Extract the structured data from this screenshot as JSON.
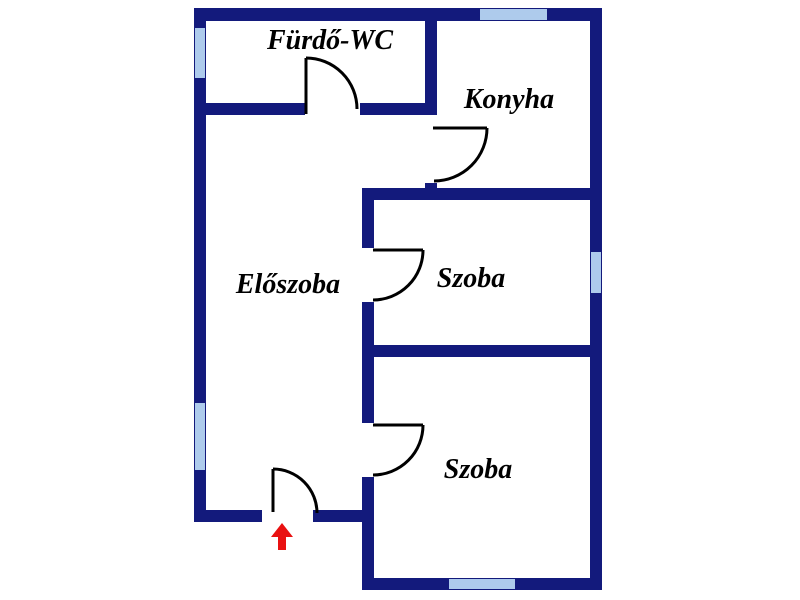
{
  "canvas": {
    "width": 800,
    "height": 600
  },
  "colors": {
    "background": "#ffffff",
    "wall": "#131a7c",
    "window": "#aecbec",
    "door_line": "#000000",
    "arrow": "#e91111",
    "text": "#000000"
  },
  "rooms": [
    {
      "name": "room-label-furdo-wc",
      "label": "Fürdő-WC",
      "x": 330,
      "y": 49
    },
    {
      "name": "room-label-konyha",
      "label": "Konyha",
      "x": 509,
      "y": 108
    },
    {
      "name": "room-label-eloszoba",
      "label": "Előszoba",
      "x": 288,
      "y": 293
    },
    {
      "name": "room-label-szoba-1",
      "label": "Szoba",
      "x": 471,
      "y": 287
    },
    {
      "name": "room-label-szoba-2",
      "label": "Szoba",
      "x": 478,
      "y": 478
    }
  ],
  "walls": [
    {
      "name": "wall-top",
      "x": 194,
      "y": 8,
      "w": 408,
      "h": 13
    },
    {
      "name": "wall-left",
      "x": 194,
      "y": 8,
      "w": 12,
      "h": 514
    },
    {
      "name": "wall-right",
      "x": 590,
      "y": 8,
      "w": 12,
      "h": 582
    },
    {
      "name": "wall-furdo-bottom-left",
      "x": 194,
      "y": 103,
      "w": 111,
      "h": 12
    },
    {
      "name": "wall-furdo-bottom-right",
      "x": 360,
      "y": 103,
      "w": 77,
      "h": 12
    },
    {
      "name": "wall-konyha-left-upper",
      "x": 425,
      "y": 8,
      "w": 12,
      "h": 107
    },
    {
      "name": "wall-konyha-left-stub",
      "x": 425,
      "y": 183,
      "w": 12,
      "h": 17
    },
    {
      "name": "wall-szoba1-top",
      "x": 362,
      "y": 188,
      "w": 240,
      "h": 12
    },
    {
      "name": "wall-middle-upper",
      "x": 362,
      "y": 188,
      "w": 12,
      "h": 60
    },
    {
      "name": "wall-middle-mid",
      "x": 362,
      "y": 302,
      "w": 12,
      "h": 121
    },
    {
      "name": "wall-middle-lower",
      "x": 362,
      "y": 477,
      "w": 12,
      "h": 113
    },
    {
      "name": "wall-szoba-divider",
      "x": 362,
      "y": 345,
      "w": 240,
      "h": 12
    },
    {
      "name": "wall-eloszoba-bottom-left",
      "x": 194,
      "y": 510,
      "w": 68,
      "h": 12
    },
    {
      "name": "wall-eloszoba-bottom-right",
      "x": 313,
      "y": 510,
      "w": 61,
      "h": 12
    },
    {
      "name": "wall-szoba2-bottom",
      "x": 362,
      "y": 578,
      "w": 240,
      "h": 12
    }
  ],
  "windows": [
    {
      "name": "window-left-upper",
      "x": 195,
      "y": 28,
      "w": 10,
      "h": 50
    },
    {
      "name": "window-left-lower",
      "x": 195,
      "y": 403,
      "w": 10,
      "h": 67
    },
    {
      "name": "window-top-konyha",
      "x": 480,
      "y": 9,
      "w": 67,
      "h": 11
    },
    {
      "name": "window-right-szoba1",
      "x": 591,
      "y": 252,
      "w": 10,
      "h": 41
    },
    {
      "name": "window-bottom-szoba2",
      "x": 449,
      "y": 579,
      "w": 66,
      "h": 10
    }
  ],
  "doors": [
    {
      "name": "door-furdo-wc",
      "leaf": "M306 114 L306 58",
      "arc": "M306 58 A51 51 0 0 1 357 109"
    },
    {
      "name": "door-konyha",
      "leaf": "M433 128 L487 128",
      "arc": "M487 128 A53 53 0 0 1 434 181"
    },
    {
      "name": "door-szoba-1",
      "leaf": "M373 250 L423 250",
      "arc": "M423 250 A50 50 0 0 1 373 300"
    },
    {
      "name": "door-szoba-2",
      "leaf": "M373 425 L423 425",
      "arc": "M423 425 A50 50 0 0 1 373 475"
    },
    {
      "name": "door-entrance",
      "leaf": "M273 512 L273 469",
      "arc": "M273 469 A44 44 0 0 1 317 513"
    }
  ],
  "entrance_arrow": {
    "name": "entrance-arrow-icon",
    "points": "282,523 271,537 278,537 278,550 286,550 286,537 293,537"
  }
}
